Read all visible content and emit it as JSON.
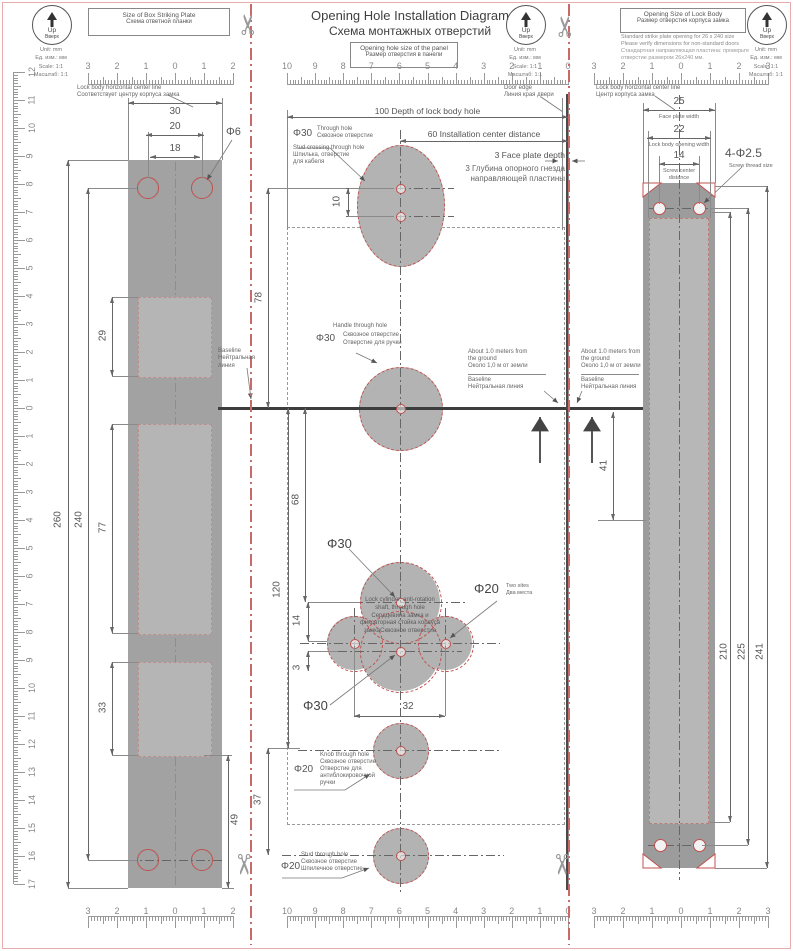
{
  "title": {
    "en": "Opening Hole Installation Diagram",
    "ru": "Схема монтажных отверстий"
  },
  "icons": {
    "up": "Up",
    "up_ru": "Вверх"
  },
  "legend": {
    "unit": "Unit: mm",
    "unit_ru": "Ед. изм.: мм",
    "scale": "Scale: 1:1",
    "scale_ru": "Масштаб: 1:1"
  },
  "colors": {
    "accent_red": "#c0504d",
    "cut_line": "#c96a6a",
    "plate_gray": "#a2a2a2",
    "plate_light": "#b5b5b5"
  },
  "left": {
    "box_en": "Size of Box Striking Plate",
    "box_ru": "Схема ответной планки",
    "centerline_en": "Lock body horizontal center line",
    "centerline_ru": "Соответствует центру корпуса замка",
    "baseline_en": "Baseline",
    "baseline_ru": "Нейтральная линия",
    "d30": "30",
    "d20": "20",
    "d18": "18",
    "dphi6": "Φ6",
    "d29": "29",
    "d77": "77",
    "d33": "33",
    "d260": "260",
    "d240": "240",
    "d49": "49"
  },
  "middle": {
    "box_en": "Opening hole size of the panel",
    "box_ru": "Размер отверстия в панели",
    "door_edge_en": "Door edge",
    "door_edge_ru": "Линия края двери",
    "d100": "100 Depth of lock body hole",
    "d60": "60 Installation center distance",
    "d3_en": "3 Face plate depth",
    "d3_ru1": "3 Глубина опорного гнезда",
    "d3_ru2": "направляющей пластины",
    "top_hole": {
      "dia": "Φ30",
      "en": "Through hole",
      "ru": "Сквозное отверстие",
      "en2": "Stud crossing through hole",
      "ru2": "Шпилька, отверстие",
      "ru3": "для кабеля"
    },
    "d10": "10",
    "d78": "78",
    "d68": "68",
    "d120": "120",
    "d14": "14",
    "d3": "3",
    "d32": "32",
    "d37": "37",
    "handle": {
      "en": "Handle through hole",
      "dia": "Φ30",
      "ru": "Сквозное отверстие",
      "ru2": "Отверстие для ручки"
    },
    "cylinder": [
      "Lock cylinder, anti-rotation",
      "shaft, through hole",
      "Сердцевина замка и",
      "фиксаторная стойка корпуса",
      "замкаСквозное отверстие"
    ],
    "phi30": "Φ30",
    "phi20": {
      "dia": "Φ20",
      "en": "Two sites",
      "ru": "Два места"
    },
    "knob": {
      "dia": "Φ20",
      "l1": "Knob through hole",
      "l2": "Сквозное отверстие",
      "l3": "Отверстие для",
      "l4": "антиблокировочной",
      "l5": "ручки"
    },
    "stud": {
      "dia": "Φ20",
      "l1": "Stud through hole",
      "l2": "Сквозное отверстие",
      "l3": "Шпилечное отверстие"
    },
    "about": {
      "l1": "About 1.0 meters from",
      "l2": "the ground",
      "l3": "Около 1,0 м от земли"
    }
  },
  "right": {
    "box_en": "Opening Size of Lock Body",
    "box_ru": "Размер отверстия корпуса замка",
    "note1": "Standard strike plate opening for 26 x 240 size",
    "note2": "Please verify dimensions for non-standard doors",
    "note3": "Стандартная направляющая пластина: проверьте",
    "note4": "отверстие размером 26x240 мм.",
    "centerline_en": "Lock body horizontal center line",
    "centerline_ru": "Центр корпуса замка",
    "d25": "25",
    "d25_label": "Face plate width",
    "d22": "22",
    "d22_label": "Lock body opening width",
    "d14": "14",
    "d14_label1": "Screw center",
    "d14_label2": "distance",
    "dphi": "4-Φ2.5",
    "dphi_label": "Screw thread size",
    "d41": "41",
    "d210": "210",
    "d225": "225",
    "d241": "241"
  },
  "rulers": {
    "left_h": [
      "3",
      "2",
      "1",
      "0",
      "1",
      "2"
    ],
    "mid_h": [
      "10",
      "9",
      "8",
      "7",
      "6",
      "5",
      "4",
      "3",
      "2",
      "1",
      "0"
    ],
    "right_h": [
      "3",
      "2",
      "1",
      "0",
      "1",
      "2",
      "3"
    ],
    "left_v": [
      "12",
      "11",
      "10",
      "9",
      "8",
      "7",
      "6",
      "5",
      "4",
      "3",
      "2",
      "1",
      "0",
      "1",
      "2",
      "3",
      "4",
      "5",
      "6",
      "7",
      "8",
      "9",
      "10",
      "11",
      "12",
      "13",
      "14",
      "15",
      "16",
      "17"
    ]
  }
}
